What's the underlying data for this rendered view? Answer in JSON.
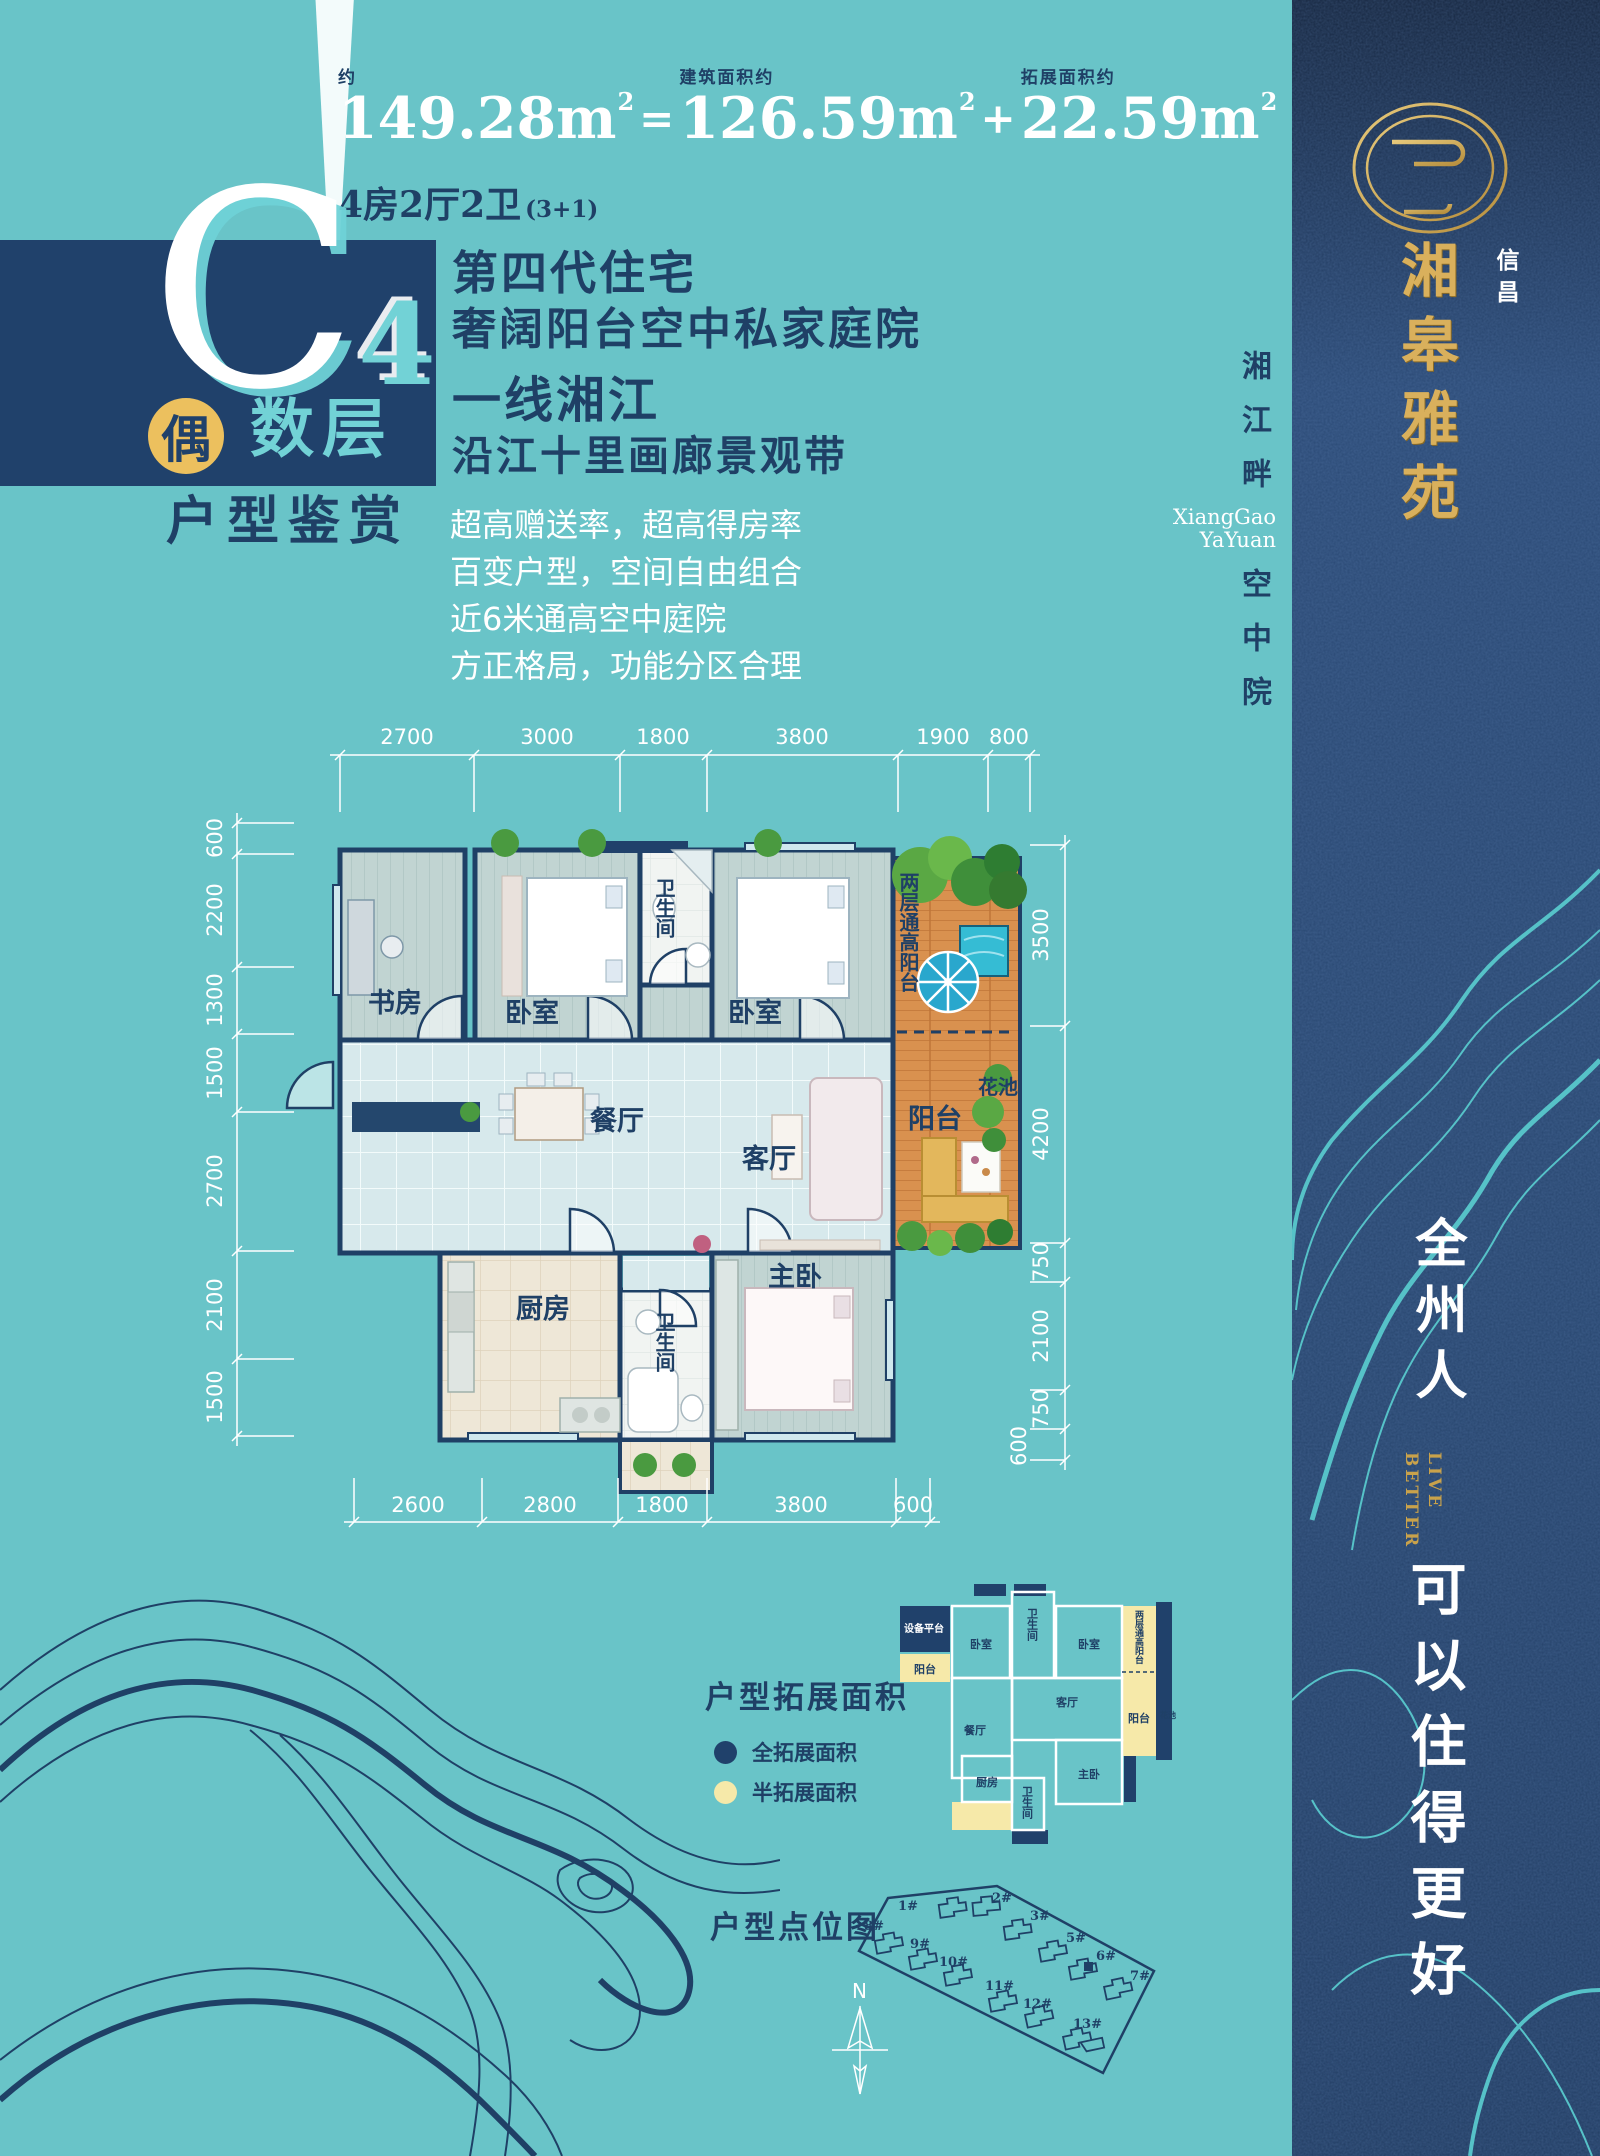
{
  "colors": {
    "teal_bg": "#69c4c8",
    "navy": "#1f4066",
    "teal_accent": "#72d2d6",
    "gold": "#d9b05c",
    "gold_dark": "#c9a24b",
    "circle_gold": "#ecc05e",
    "half_ext_yellow": "#f6e9a9",
    "full_ext_navy": "#20416b",
    "deck_orange": "#d9914f",
    "sidebar_blue": "#2b4a76",
    "white": "#ffffff"
  },
  "stats": {
    "g1_label": "约",
    "g1_value": "149.28",
    "g2_label": "建筑面积约",
    "g2_value": "126.59",
    "g3_label": "拓展面积约",
    "g3_value": "22.59",
    "unit": "m",
    "sup": "2",
    "eq": "=",
    "plus": "+",
    "spec": "4房2厅2卫",
    "spec_note": "(3+1)"
  },
  "badge": {
    "letter": "C",
    "num": "4",
    "circle": "偶",
    "floors": "数层",
    "caption": "户型鉴赏"
  },
  "headlines": {
    "h1": "第四代住宅",
    "h2": "奢阔阳台空中私家庭院",
    "h3": "一线湘江",
    "h4": "沿江十里画廊景观带"
  },
  "bullets": [
    "超高赠送率，超高得房率",
    "百变户型，空间自由组合",
    "近6米通高空中庭院",
    "方正格局，功能分区合理"
  ],
  "plan": {
    "dims_top": [
      "2700",
      "3000",
      "1800",
      "3800",
      "1900",
      "800"
    ],
    "dims_left": [
      "600",
      "2200",
      "1300",
      "1500",
      "2700",
      "2100",
      "1500"
    ],
    "dims_right": [
      "3500",
      "4200",
      "750",
      "2100",
      "750",
      "600"
    ],
    "dims_bottom": [
      "2600",
      "2800",
      "1800",
      "3800",
      "600"
    ],
    "rooms": {
      "study": "书房",
      "bedroom": "卧室",
      "bath": "卫生间",
      "bedroom2": "卧室",
      "dining": "餐厅",
      "living": "客厅",
      "kitchen": "厨房",
      "bath2": "卫生间",
      "master": "主卧",
      "balcony": "阳台",
      "flower": "花池",
      "tall_balcony": "两层通高阳台"
    }
  },
  "extension": {
    "title": "户型拓展面积",
    "legend_full": "全拓展面积",
    "legend_half": "半拓展面积",
    "mini": {
      "equip": "设备平台",
      "balcony": "阳台",
      "bedroom": "卧室",
      "bath": "卫生间",
      "bedroom2": "卧室",
      "tall_balcony": "两层通高阳台",
      "living": "客厅",
      "dining": "餐厅",
      "kitchen": "厨房",
      "bath2": "卫生间",
      "master": "主卧",
      "balcony2": "阳台",
      "flower": "花池"
    }
  },
  "site": {
    "title": "户型点位图",
    "compass": "N",
    "highlighted": "6#",
    "buildings": [
      "1#",
      "2#",
      "3#",
      "5#",
      "6#",
      "7#",
      "8#",
      "9#",
      "10#",
      "11#",
      "12#",
      "13#"
    ]
  },
  "sidebar": {
    "brand_sub": "信昌",
    "brand": "湘皋雅苑",
    "tag1": "湘江畔",
    "tag_en1": "XiangGao",
    "tag_en2": "YaYuan",
    "tag2": "空中院",
    "slogan1": "全州人",
    "slogan_en1": "LIVE",
    "slogan_en2": "BETTER",
    "slogan2": "可以住得更好"
  }
}
